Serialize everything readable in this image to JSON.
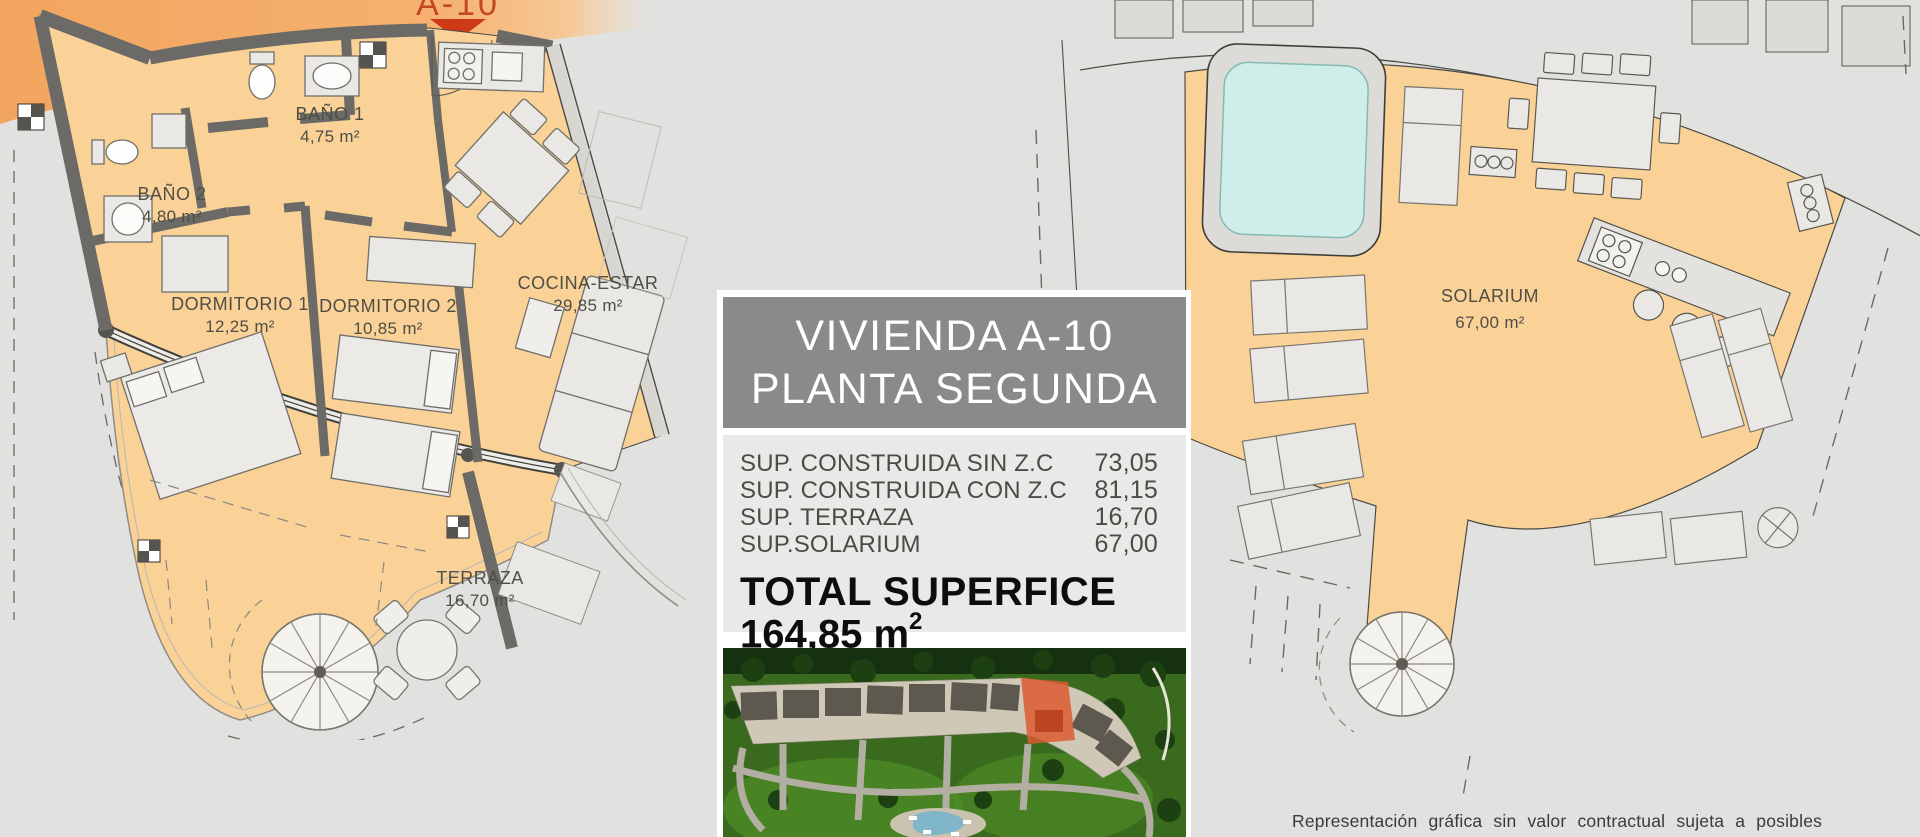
{
  "marker": {
    "label": "A-10"
  },
  "plans": {
    "left": {
      "rooms": [
        {
          "name": "BAÑO 1",
          "area": "4,75 m²"
        },
        {
          "name": "BAÑO 2",
          "area": "4,80 m²"
        },
        {
          "name": "DORMITORIO 1",
          "area": "12,25 m²"
        },
        {
          "name": "DORMITORIO 2",
          "area": "10,85 m²"
        },
        {
          "name": "COCINA-ESTAR",
          "area": "29,85 m²"
        },
        {
          "name": "TERRAZA",
          "area": "16,70 m²"
        }
      ]
    },
    "right": {
      "rooms": [
        {
          "name": "SOLARIUM",
          "area": "67,00 m²"
        }
      ]
    }
  },
  "info_panel": {
    "title_line1": "VIVIENDA A-10",
    "title_line2": "PLANTA SEGUNDA",
    "rows": [
      {
        "label": "SUP. CONSTRUIDA SIN Z.C",
        "value": "73,05"
      },
      {
        "label": "SUP. CONSTRUIDA CON Z.C",
        "value": "81,15"
      },
      {
        "label": "SUP. TERRAZA",
        "value": "16,70"
      },
      {
        "label": "SUP.SOLARIUM",
        "value": "67,00"
      }
    ],
    "total_label": "TOTAL SUPERFICE",
    "total_value": "164,85 m",
    "total_superscript": "2"
  },
  "disclaimer": "Representación gráfica sin valor contractual sujeta a posibles",
  "colors": {
    "floor_orange": "#fad298",
    "banner_orange": "#f2a55f",
    "marker_red": "#cd3a15",
    "wall_gray": "#6b6a66",
    "pool_cyan": "#cfeeea",
    "title_box_gray": "#8a8a88",
    "info_box_gray": "#e9e9e7",
    "highlight_red": "#dd5a31"
  }
}
